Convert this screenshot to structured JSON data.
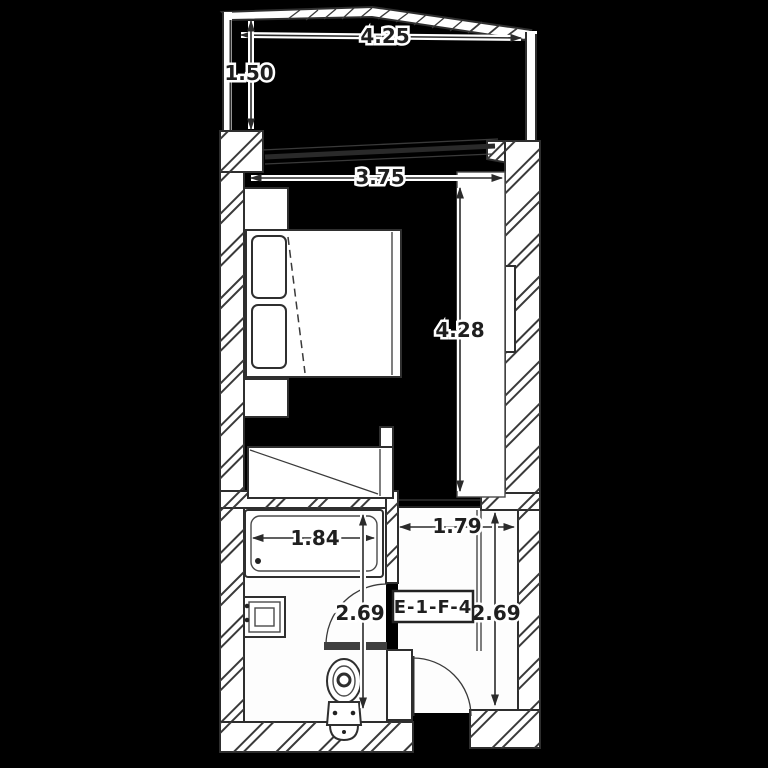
{
  "colors": {
    "background": "#000000",
    "line": "#2e2e2e",
    "fill": "#ffffff"
  },
  "unit": {
    "label": "E-1-F-4"
  },
  "dimensions": {
    "balcony_width": {
      "value": "4.25"
    },
    "balcony_depth": {
      "value": "1.50"
    },
    "room_width": {
      "value": "3.75"
    },
    "room_length": {
      "value": "4.28"
    },
    "bathtub_length": {
      "value": "1.84"
    },
    "hall_width": {
      "value": "1.79"
    },
    "bathroom_length": {
      "value": "2.69"
    },
    "hall_length": {
      "value": "2.69"
    }
  },
  "fixtures": [
    "balcony-railing",
    "sliding-window",
    "double-bed",
    "pillow",
    "nightstand",
    "desk",
    "wardrobe",
    "bathtub",
    "washbasin",
    "toilet",
    "bathroom-door",
    "entry-door"
  ]
}
